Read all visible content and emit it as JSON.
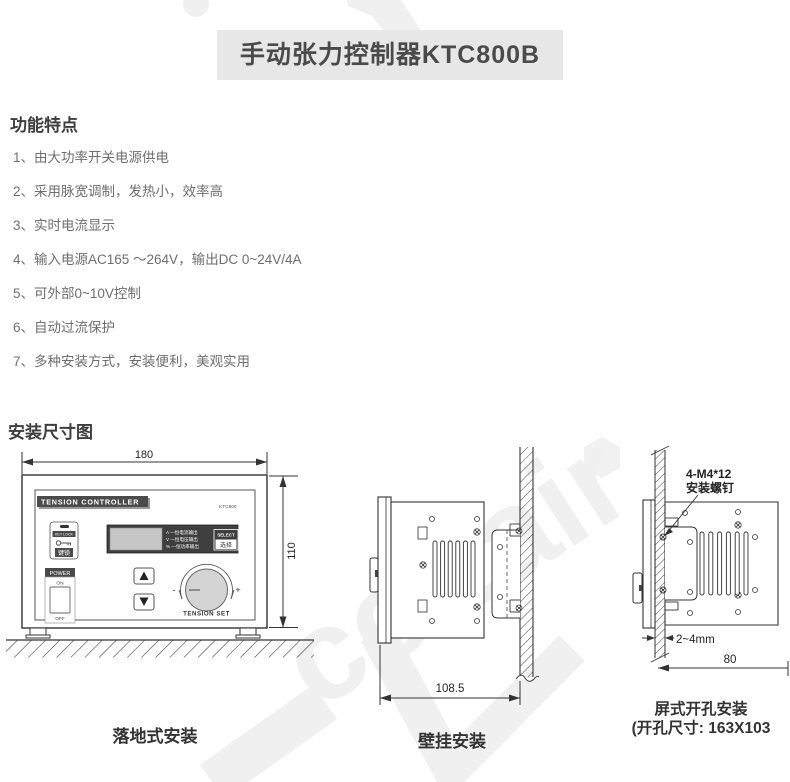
{
  "page": {
    "title": "手动张力控制器KTC800B"
  },
  "features": {
    "heading": "功能特点",
    "items": [
      "1、由大功率开关电源供电",
      "2、采用脉宽调制，发热小，效率高",
      "3、实时电流显示",
      "4、输入电源AC165 ～264V，输出DC 0~24V/4A",
      "5、可外部0~10V控制",
      "6、自动过流保护",
      "7、多种安装方式，安装便利，美观实用"
    ]
  },
  "installation": {
    "heading": "安装尺寸图",
    "floor_mount": {
      "caption": "落地式安装",
      "width_dim": "180",
      "height_dim": "110",
      "panel": {
        "brand": "TENSION CONTROLLER",
        "model": "KTC800",
        "keylock_label": "KEY LOCK",
        "keylock_cn": "键锁",
        "power_label": "POWER",
        "power_on": "ON",
        "power_off": "OFF",
        "display_line1": "A —恒电流输出",
        "display_line2": "V —恒电压输出",
        "display_line3": "% —恒功率输出",
        "select_label": "SELECT",
        "select_cn": "选择",
        "knob_label": "TENSION SET",
        "minus": "-",
        "plus": "+"
      }
    },
    "wall_mount": {
      "caption": "壁挂安装",
      "depth_dim": "108.5"
    },
    "panel_mount": {
      "caption_line1": "屏式开孔安装",
      "caption_line2": "(开孔尺寸: 163X103",
      "screw_note_line1": "4-M4*12",
      "screw_note_line2": "安装螺钉",
      "panel_thickness_dim": "2~4mm",
      "depth_dim": "80"
    }
  },
  "watermark": {
    "text": "ccLair"
  },
  "colors": {
    "title_bg": "#e7e7e7",
    "title_text": "#4a4a4a",
    "heading_text": "#3d3d3d",
    "body_text": "#6e6e6e",
    "line": "#333333",
    "watermark": "#f0f0f0"
  }
}
